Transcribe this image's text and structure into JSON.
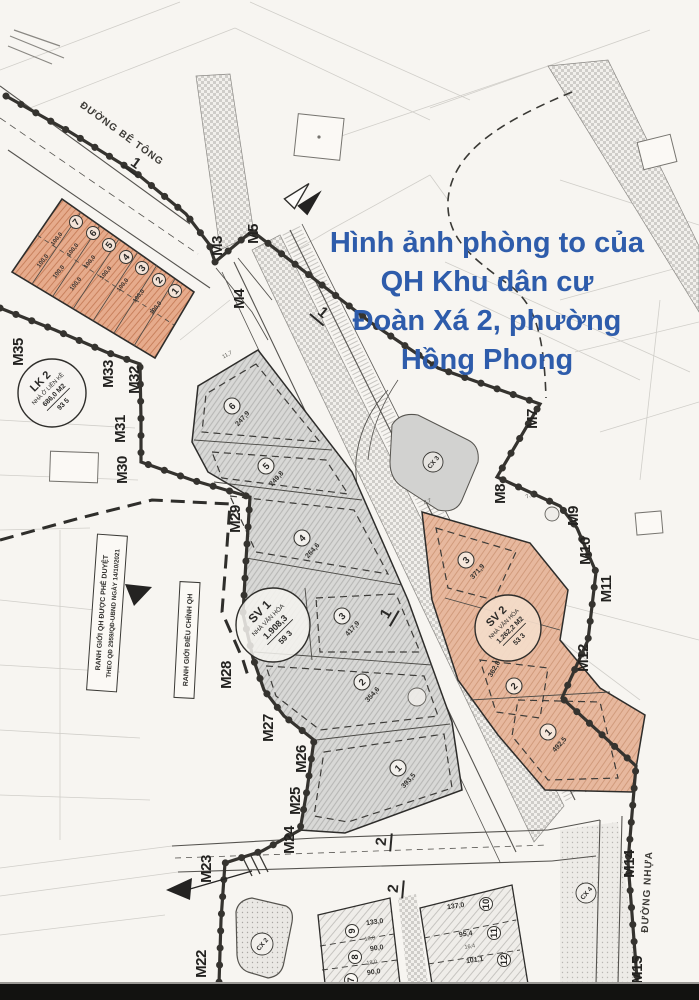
{
  "title": {
    "lines": [
      "Hình ảnh phòng to của",
      "QH Khu dân cư",
      "Đoàn Xá 2, phường",
      "Hồng Phong"
    ],
    "color": "#2e5cab"
  },
  "legend": {
    "approved_line1": "RANH GIỚI QH ĐƯỢC PHÊ DUYỆT",
    "approved_line2": "THEO QĐ 2959/QĐ-UBND NGÀY 14/10/2021",
    "adjusted": "RANH GIỚI ĐIỀU CHỈNH QH"
  },
  "roads": {
    "concrete": "ĐƯỜNG BÊ TÔNG",
    "asphalt": "ĐƯỜNG NHỰA",
    "r1": "1",
    "r2": "2"
  },
  "markers": {
    "m3": "M3",
    "m4": "M4",
    "m5": "M5",
    "m7": "M7",
    "m8": "M8",
    "m9": "M9",
    "m10": "M10",
    "m11": "M11",
    "m12": "M12",
    "m14": "M14",
    "m15": "M15",
    "m22": "M22",
    "m23": "M23",
    "m24": "M24",
    "m25": "M25",
    "m26": "M26",
    "m27": "M27",
    "m28": "M28",
    "m29": "M29",
    "m30": "M30",
    "m31": "M31",
    "m32": "M32",
    "m33": "M33",
    "m35": "M35"
  },
  "badges": {
    "lk2": {
      "code": "LK 2",
      "name": "NHÀ Ở LIỀN KỀ",
      "area": "686,0 M2",
      "ratio": "93 5"
    },
    "sv1": {
      "code": "SV 1",
      "name": "NHÀ VĂN HÓA",
      "area": "1.908,3",
      "ratio": "59 3"
    },
    "sv2": {
      "code": "SV 2",
      "name": "NHÀ VĂN HÓA",
      "area": "1.262,2 M2",
      "ratio": "53 3"
    },
    "cx2": {
      "code": "CX 2"
    },
    "cx3": {
      "code": "CX 3"
    },
    "cx4": {
      "code": "CX 4"
    }
  },
  "lots": {
    "lk2_area": "100,0",
    "lk2_numbers": [
      "7",
      "6",
      "5",
      "4",
      "3",
      "2",
      "1"
    ],
    "central": [
      {
        "n": "6",
        "area": "247,9"
      },
      {
        "n": "5",
        "area": "249,8"
      },
      {
        "n": "4",
        "area": "264,6"
      },
      {
        "n": "3",
        "area": "417,9"
      },
      {
        "n": "2",
        "area": "354,6"
      },
      {
        "n": "1",
        "area": "393,5"
      }
    ],
    "sv2_block": [
      {
        "n": "3",
        "area": "371,9"
      },
      {
        "n": "2",
        "area": "362,8"
      },
      {
        "n": "1",
        "area": "492,5"
      }
    ],
    "bottom_left": [
      {
        "n": "9",
        "area": "133,0",
        "w": "18,0"
      },
      {
        "n": "8",
        "area": "90,0",
        "w": "18,0"
      },
      {
        "n": "7",
        "area": "90,0"
      }
    ],
    "bottom_right": [
      {
        "n": "10",
        "area": "137,0"
      },
      {
        "n": "11",
        "area": "95,4",
        "w": "16,4"
      },
      {
        "n": "12",
        "area": "101,1"
      }
    ]
  },
  "dims": {
    "d1": "11,7",
    "d2": "8,7",
    "d3": "7,5"
  }
}
